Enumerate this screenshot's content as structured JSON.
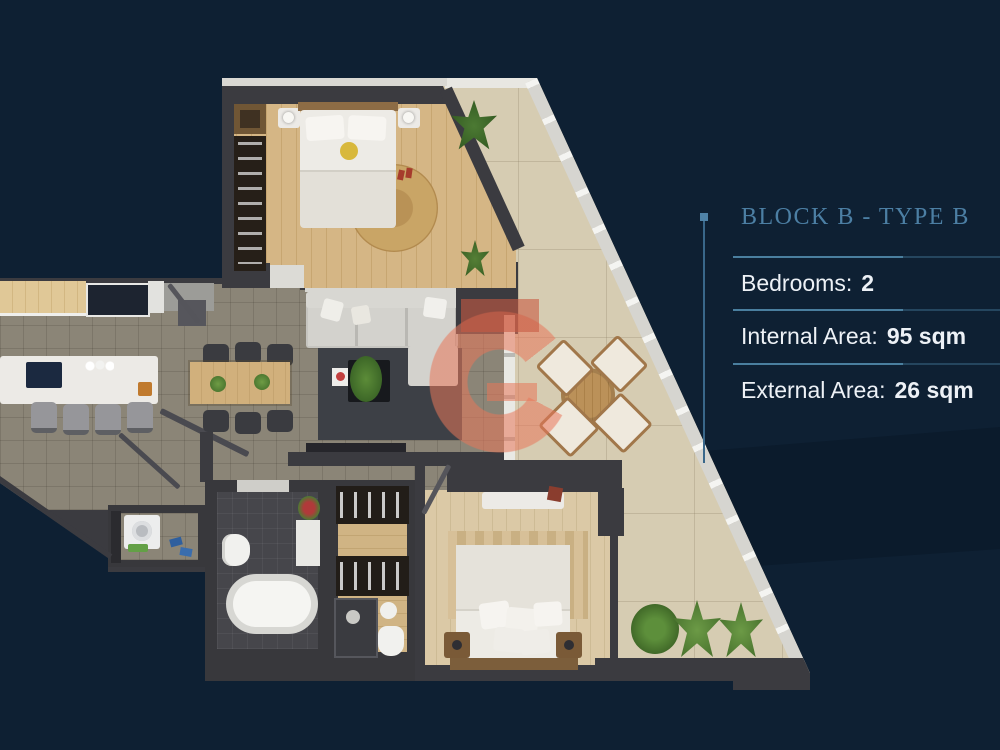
{
  "panel": {
    "title": "BLOCK B - TYPE B",
    "stats": [
      {
        "label": "Bedrooms:",
        "value": "2"
      },
      {
        "label": "Internal Area:",
        "value": "95 sqm"
      },
      {
        "label": "External Area:",
        "value": "26 sqm"
      }
    ]
  },
  "colors": {
    "background": "#0e2033",
    "background_band": "#0b1b2c",
    "title_accent": "#4c7fa4",
    "divider_bright": "#4a7f9f",
    "divider_dim": "#25465f",
    "stat_text": "#edf1f6",
    "wall": "#3b3b40",
    "bedroom_wood": "#d2b383",
    "terrace_stone": "#d6ccb2",
    "living_tile": "#8b8577",
    "watermark_coral": "#e8765a"
  }
}
